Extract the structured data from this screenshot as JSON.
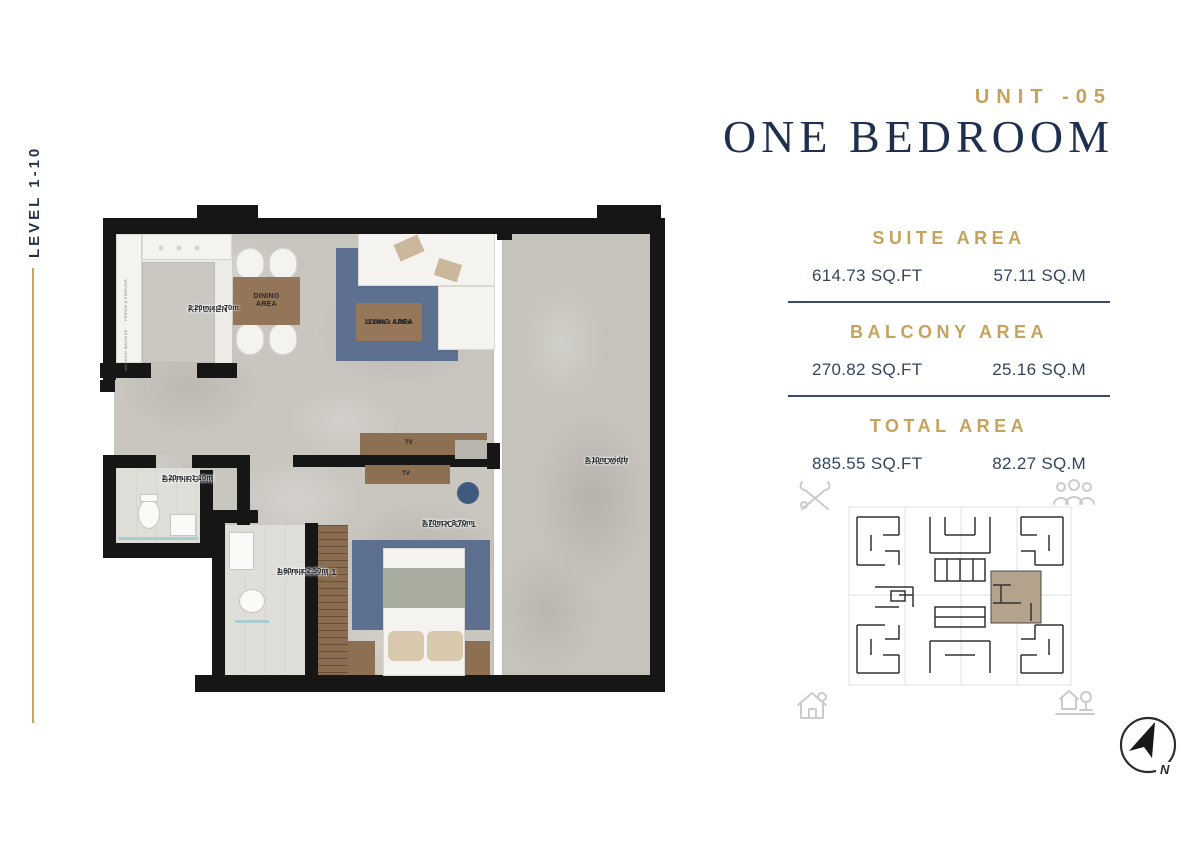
{
  "header": {
    "unit_label": "UNIT -05",
    "title": "ONE BEDROOM"
  },
  "left_rail": {
    "level_label": "LEVEL 1-10"
  },
  "area_panel": {
    "sections": [
      {
        "heading": "SUITE AREA",
        "imperial": "614.73 SQ.FT",
        "metric": "57.11 SQ.M"
      },
      {
        "heading": "BALCONY AREA",
        "imperial": "270.82 SQ.FT",
        "metric": "25.16 SQ.M"
      },
      {
        "heading": "TOTAL AREA",
        "imperial": "885.55 SQ.FT",
        "metric": "82.27 SQ.M"
      }
    ]
  },
  "floor_plan": {
    "rooms": [
      {
        "name": "KITCHEN",
        "dims": "2.20m x 2.70m"
      },
      {
        "name": "DINING AREA",
        "dims": ""
      },
      {
        "name": "LIVING AREA",
        "dims": "5.20m x 4.00m"
      },
      {
        "name": "BATHROOM",
        "dims": "2.20m x 1.10m"
      },
      {
        "name": "BATHROOM 1",
        "dims": "1.60m x 2.50m"
      },
      {
        "name": "BEDROOM 1",
        "dims": "3.70m x 3.70m"
      },
      {
        "name": "BALCONY",
        "dims": "3.10m width"
      }
    ],
    "tv_label": "TV",
    "appliance_labels": [
      "FRIDGE & FREEZER",
      "WASHING MACHINE"
    ]
  },
  "compass": {
    "north_label": "N"
  },
  "colors": {
    "gold": "#c6a35c",
    "navy_title": "#1f304e",
    "value_text": "#33465f",
    "divider": "#3a4d68",
    "wall": "#161616",
    "rug_blue": "#5d7090",
    "wood_brown": "#93755a",
    "floor_gray": "#c9c5bf",
    "balcony_gray": "#c6c3bc",
    "highlight_beige": "#b3a28c"
  }
}
